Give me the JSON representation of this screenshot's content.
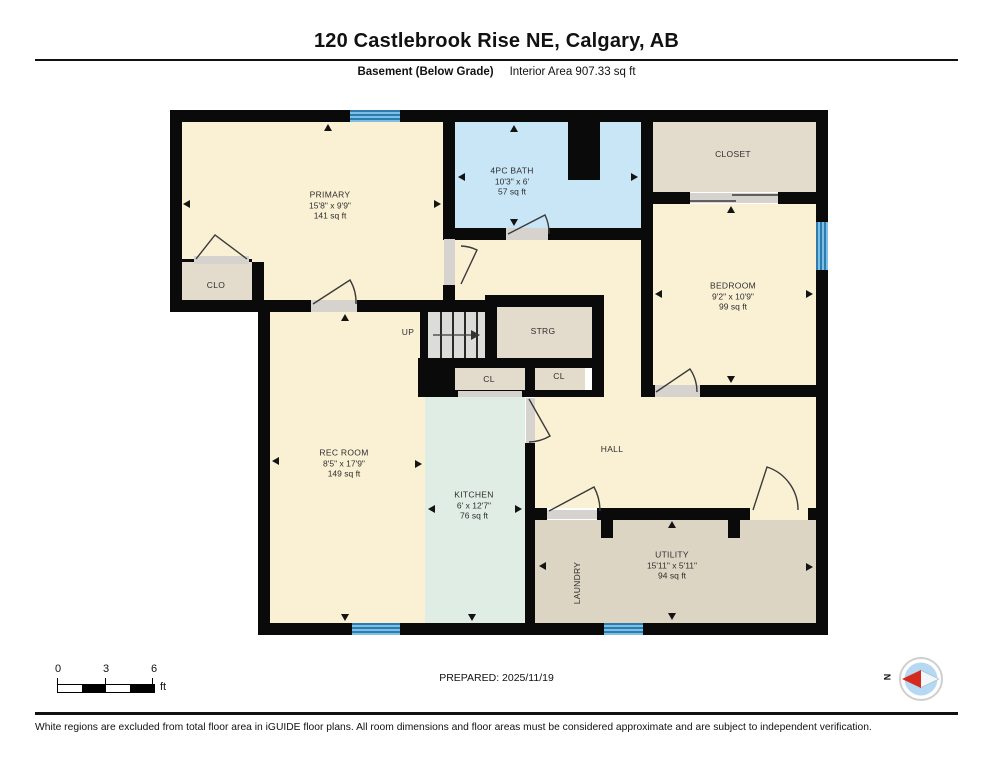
{
  "header": {
    "title": "120 Castlebrook Rise NE, Calgary, AB",
    "floor_label": "Basement (Below Grade)",
    "area_label": "Interior Area 907.33 sq ft"
  },
  "rooms": {
    "primary": {
      "name": "PRIMARY",
      "dims": "15'8\" x 9'9\"",
      "area": "141 sq ft"
    },
    "bath": {
      "name": "4PC BATH",
      "dims": "10'3\" x 6'",
      "area": "57 sq ft"
    },
    "closet": {
      "name": "CLOSET"
    },
    "bedroom": {
      "name": "BEDROOM",
      "dims": "9'2\" x 10'9\"",
      "area": "99 sq ft"
    },
    "clo": {
      "name": "CLO"
    },
    "up": {
      "name": "UP"
    },
    "strg": {
      "name": "STRG"
    },
    "cl1": {
      "name": "CL"
    },
    "cl2": {
      "name": "CL"
    },
    "rec": {
      "name": "REC ROOM",
      "dims": "8'5\" x 17'9\"",
      "area": "149 sq ft"
    },
    "kitchen": {
      "name": "KITCHEN",
      "dims": "6' x 12'7\"",
      "area": "76 sq ft"
    },
    "hall": {
      "name": "HALL"
    },
    "laundry": {
      "name": "LAUNDRY"
    },
    "utility": {
      "name": "UTILITY",
      "dims": "15'11\" x 5'11\"",
      "area": "94 sq ft"
    }
  },
  "scale": {
    "t0": "0",
    "t1": "3",
    "t2": "6",
    "unit": "ft"
  },
  "prepared": "PREPARED: 2025/11/19",
  "disclaimer": "White regions are excluded from total floor area in iGUIDE floor plans. All room dimensions and floor areas must be considered approximate and are subject to independent verification.",
  "compass": {
    "north": "N"
  },
  "colors": {
    "wall": "#0a0a0a",
    "cream": "#faf0d4",
    "bath": "#c9e6f7",
    "tan": "#e3dccd",
    "utility": "#ddd5c4",
    "kitchen": "#dfede4",
    "stairs": "#dcdcd8",
    "threshold": "#d6d3ce",
    "window_dark": "#2d7cac",
    "window_light": "#7cc0e8",
    "accent_red": "#d42b1e"
  }
}
